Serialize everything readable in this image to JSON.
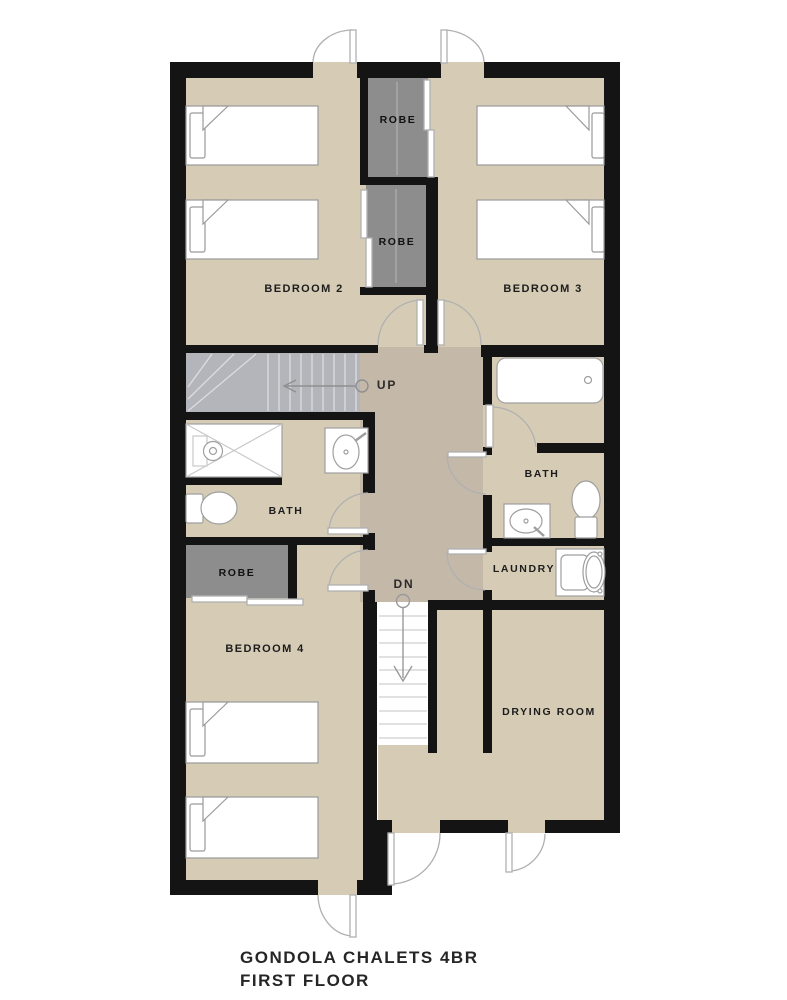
{
  "title": {
    "line1": "GONDOLA CHALETS 4BR",
    "line2": "FIRST FLOOR"
  },
  "rooms": {
    "bedroom2": "BEDROOM 2",
    "bedroom3": "BEDROOM 3",
    "bedroom4": "BEDROOM 4",
    "bath_left": "BATH",
    "bath_right": "BATH",
    "laundry": "LAUNDRY",
    "drying_room": "DRYING ROOM",
    "robe_top": "ROBE",
    "robe_middle": "ROBE",
    "robe_bedroom4": "ROBE"
  },
  "stairs": {
    "up": "UP",
    "dn": "DN"
  },
  "colors": {
    "wall": "#141414",
    "room_floor": "#d6ccb6",
    "hallway_floor": "#c4b8a8",
    "stair_floor": "#b4b4bb",
    "robe_floor": "#8d8d8d",
    "fixture_stroke": "#9f9f9f",
    "door_stroke": "#b0b0b0",
    "label_color": "#1c1c1c"
  }
}
